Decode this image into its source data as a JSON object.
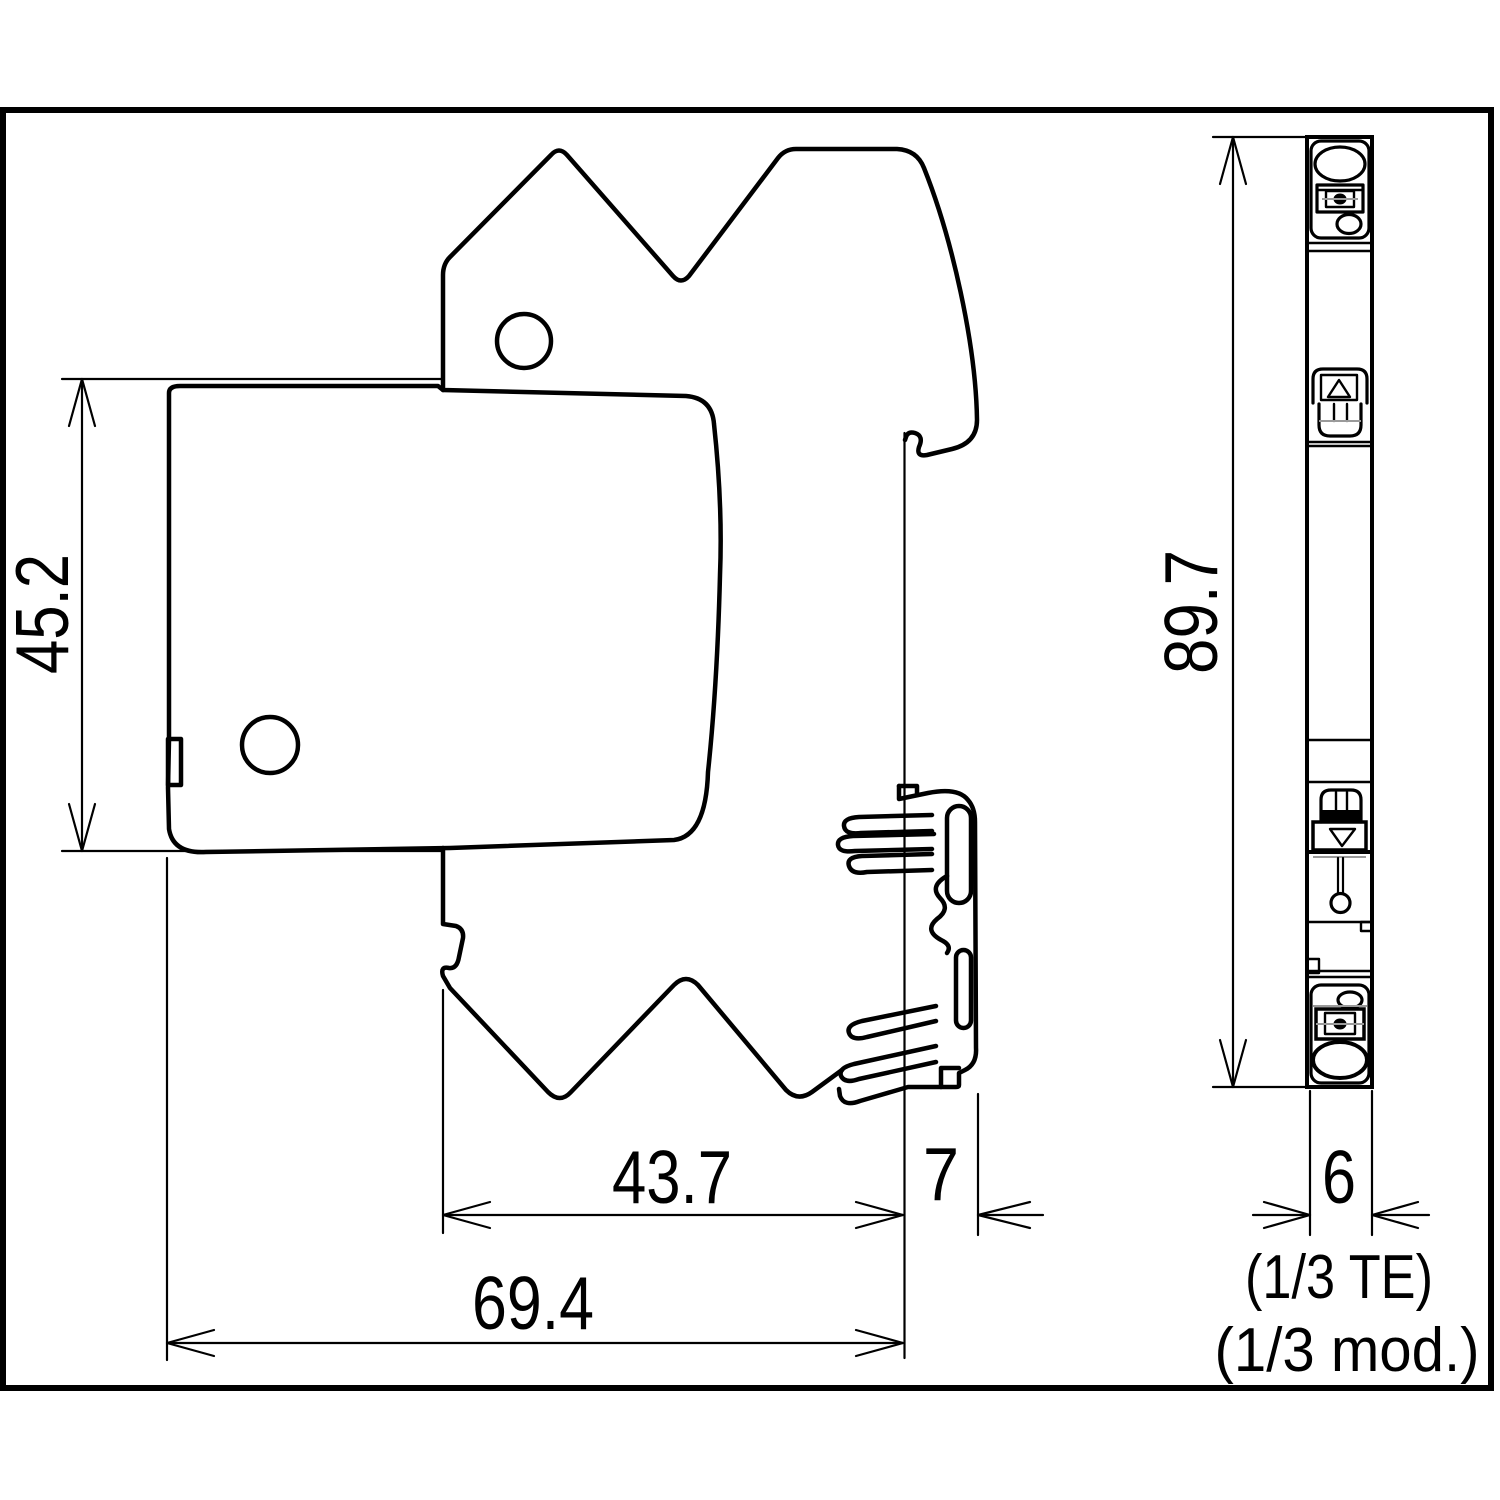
{
  "drawing": {
    "kind": "technical dimension drawing, DIN-rail surge protection module, side and front views",
    "units": "mm",
    "colors": {
      "line": "#000000",
      "background": "#ffffff",
      "detail_gray": "#9a9a9a"
    }
  },
  "dimensions": {
    "body_height": "45.2",
    "total_height": "89.7",
    "body_depth": "43.7",
    "rail_offset": "7",
    "total_depth": "69.4",
    "module_width": "6",
    "width_note_te": "(1/3 TE)",
    "width_note_mod": "(1/3 mod.)"
  }
}
